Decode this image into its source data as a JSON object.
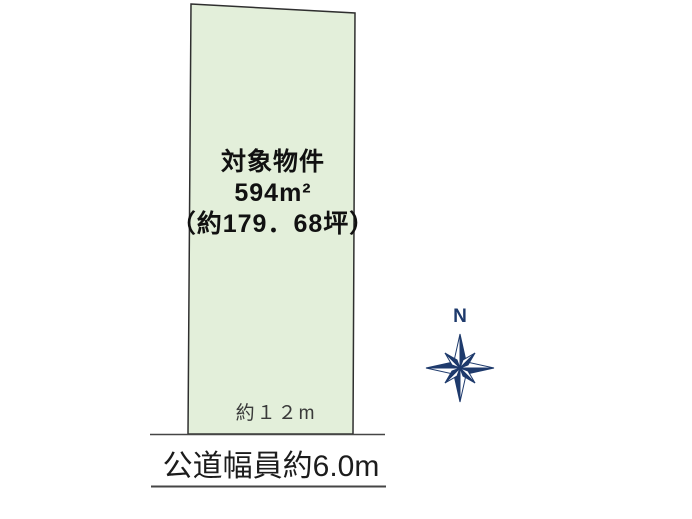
{
  "colors": {
    "plot_fill": "#e3efda",
    "plot_stroke": "#2f2f2f",
    "road_line": "#454545",
    "compass_navy": "#1e3a6c",
    "label_text": "#111111",
    "dimension_text": "#3a3a3a"
  },
  "plot": {
    "label_line1": "対象物件",
    "label_line2": "594m²",
    "label_line3": "（約179．68坪）",
    "frontage_label": "約１２m"
  },
  "road": {
    "label": "公道幅員約6.0m"
  },
  "compass": {
    "north_label": "N"
  }
}
